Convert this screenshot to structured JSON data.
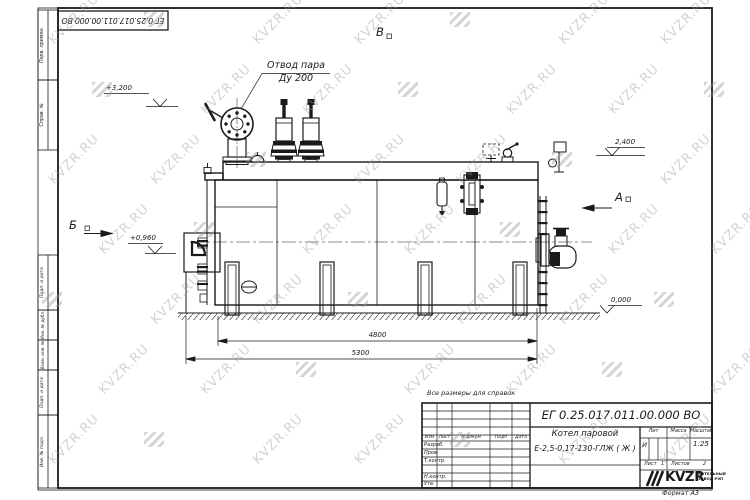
{
  "sheet": {
    "doc_number": "ЕГ 0.25.017.011.00.000  ВО",
    "note": "Все размеры для справок",
    "format_label": "Формат А3"
  },
  "watermark": {
    "text": "KVZR.RU"
  },
  "margin_stamps": {
    "perv_primen": "Перв. примен.",
    "sprav_n": "Справ. №",
    "podp_data_1": "Подп. и дата",
    "inv_dubl": "Инв. № дубл.",
    "vzam_inv": "Взам. инв. №",
    "podp_data_2": "Подп. и дата",
    "inv_podl": "Инв. № подл."
  },
  "drawing": {
    "callout_steam": {
      "line1": "Отвод пара",
      "line2": "Ду 200"
    },
    "elevation_3200": "+3,200",
    "elevation_2400": "2,400",
    "elevation_0960": "+0,960",
    "elevation_0000": "0,000",
    "view_v": "В",
    "view_a": "А",
    "view_b": "Б",
    "dim_4800": "4800",
    "dim_5300": "5300"
  },
  "title_block": {
    "doc_number": "ЕГ 0.25.017.011.00.000  ВО",
    "name_line1": "Котел паровой",
    "name_line2": "Е-2,5-0,17-130-ГЛЖ ( Ж )",
    "col_izm": "Изм",
    "col_list": "Лист",
    "col_ndokum": "N докум",
    "col_podp": "Подп",
    "col_data": "Дата",
    "row_razrab": "Разраб.",
    "row_prov": "Пров.",
    "row_tkontr": "Т.контр.",
    "row_nkontr": "Н.контр.",
    "row_utv": "Утв.",
    "lit_label": "Лит",
    "lit_value": "И",
    "massa_label": "Масса",
    "masshtab_label": "Масштаб",
    "masshtab_value": "1:25",
    "list_label": "Лист",
    "list_value": "1",
    "listov_label": "Листов",
    "listov_value": "2",
    "logo_text": "KVZR",
    "logo_caption_line1": "КОТЕЛЬНЫЙ",
    "logo_caption_line2": "ЗАВОД РЭП"
  }
}
